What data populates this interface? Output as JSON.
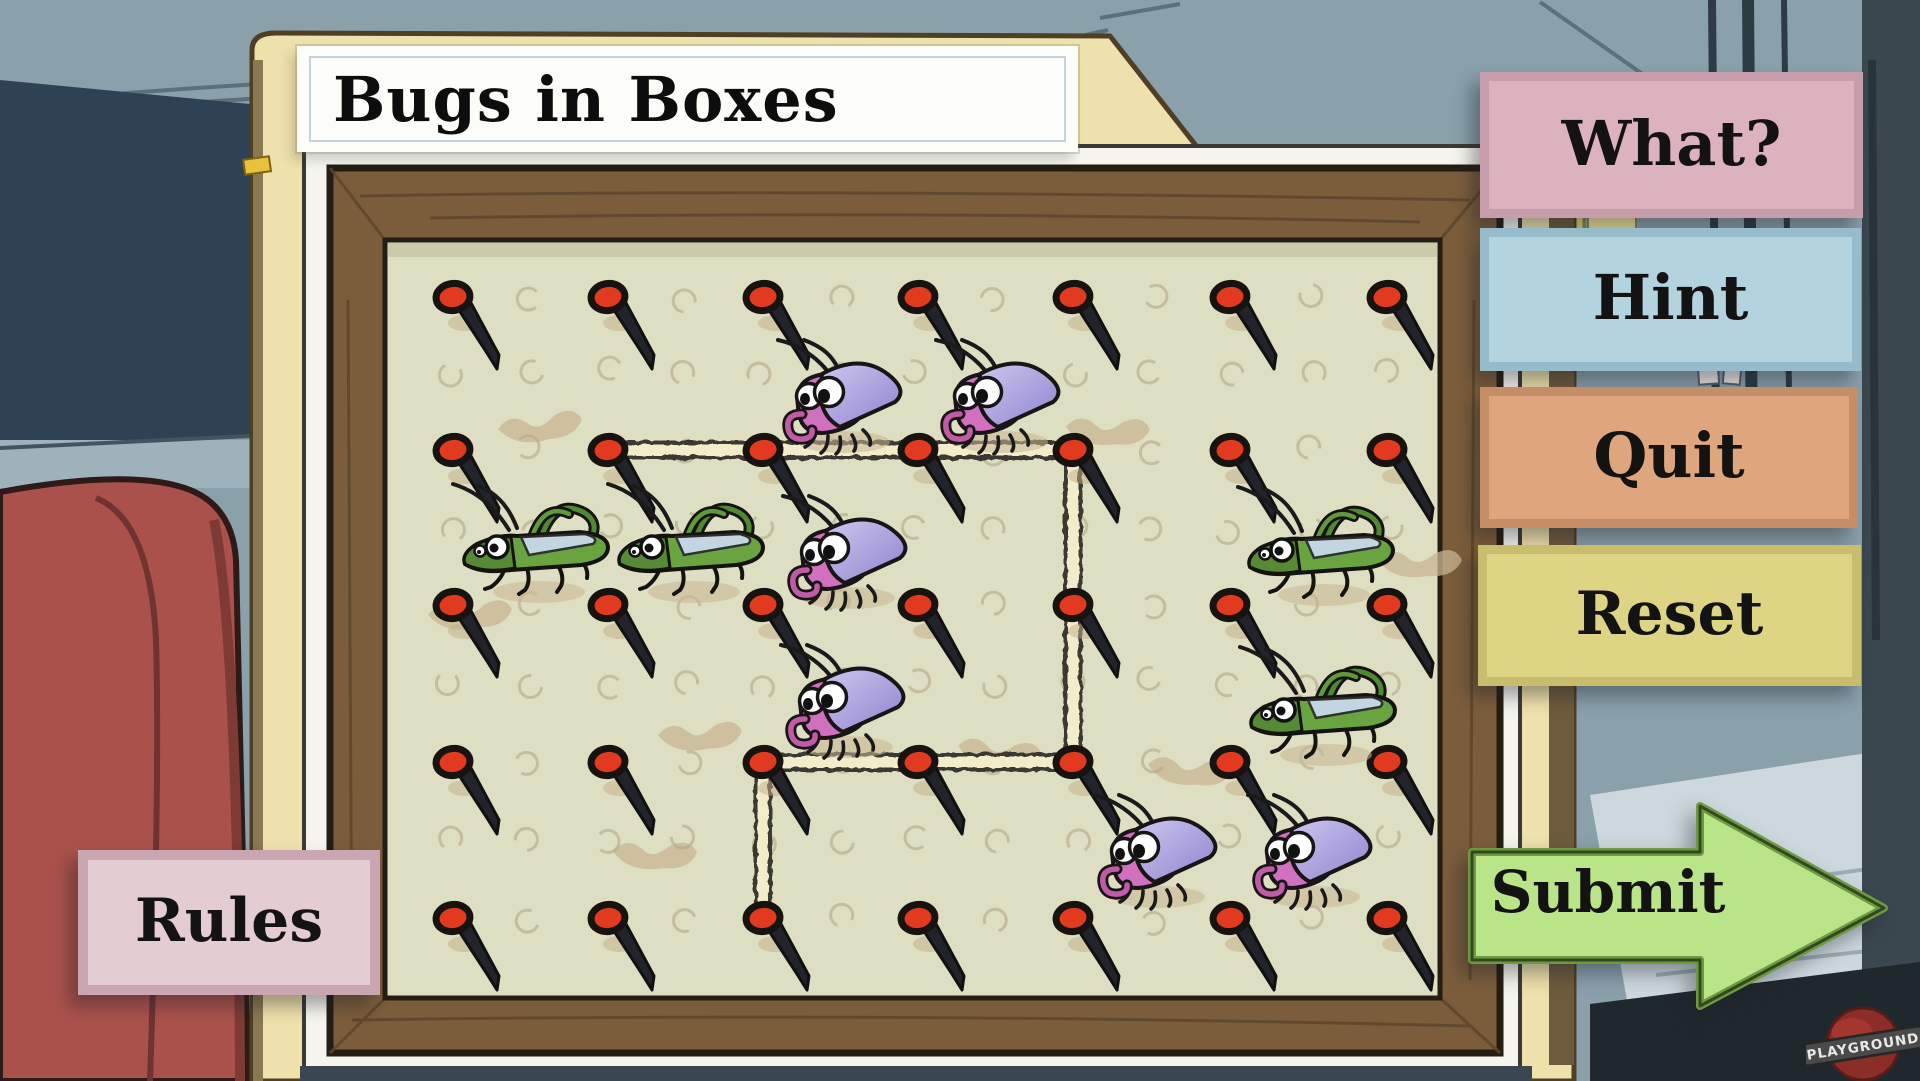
{
  "title": "Bugs in Boxes",
  "buttons": {
    "what": "What?",
    "hint": "Hint",
    "quit": "Quit",
    "reset": "Reset",
    "submit": "Submit",
    "rules": "Rules"
  },
  "logo": {
    "text": "PLAYGROUND"
  },
  "board": {
    "grid": {
      "cols": [
        453,
        608,
        763,
        918,
        1073,
        1230,
        1387
      ],
      "rows": [
        297,
        450,
        605,
        762,
        918
      ]
    },
    "rubber_band": [
      [
        608,
        450
      ],
      [
        1073,
        450
      ],
      [
        1073,
        762
      ],
      [
        763,
        762
      ],
      [
        763,
        918
      ]
    ],
    "bugs": [
      {
        "type": "grasshopper",
        "x": 535,
        "y": 550
      },
      {
        "type": "grasshopper",
        "x": 690,
        "y": 550
      },
      {
        "type": "grasshopper",
        "x": 1320,
        "y": 553
      },
      {
        "type": "grasshopper",
        "x": 1322,
        "y": 713
      },
      {
        "type": "roach",
        "x": 840,
        "y": 400
      },
      {
        "type": "roach",
        "x": 998,
        "y": 400
      },
      {
        "type": "roach",
        "x": 845,
        "y": 556
      },
      {
        "type": "roach",
        "x": 843,
        "y": 705
      },
      {
        "type": "roach",
        "x": 1155,
        "y": 855
      },
      {
        "type": "roach",
        "x": 1310,
        "y": 855
      }
    ],
    "smudges": [
      [
        540,
        424
      ],
      [
        1108,
        428
      ],
      [
        700,
        733
      ],
      [
        1000,
        750
      ],
      [
        655,
        852
      ],
      [
        470,
        612
      ],
      [
        1190,
        768
      ],
      [
        1420,
        560
      ]
    ]
  },
  "colors": {
    "pin_red": "#e13a1e",
    "cork": "#dedec2",
    "frame_brown": "#7b5d3b",
    "band_cream": "#f2ecca",
    "band_edge": "#33302a",
    "hole": "#b3a887",
    "smudge": "#c8b693",
    "hopper_green": "#69a441",
    "roach_pink": "#d170be",
    "roach_shell": "#b0a6e0",
    "submit_green": "#b9e488",
    "submit_border": "#6c9a40"
  }
}
